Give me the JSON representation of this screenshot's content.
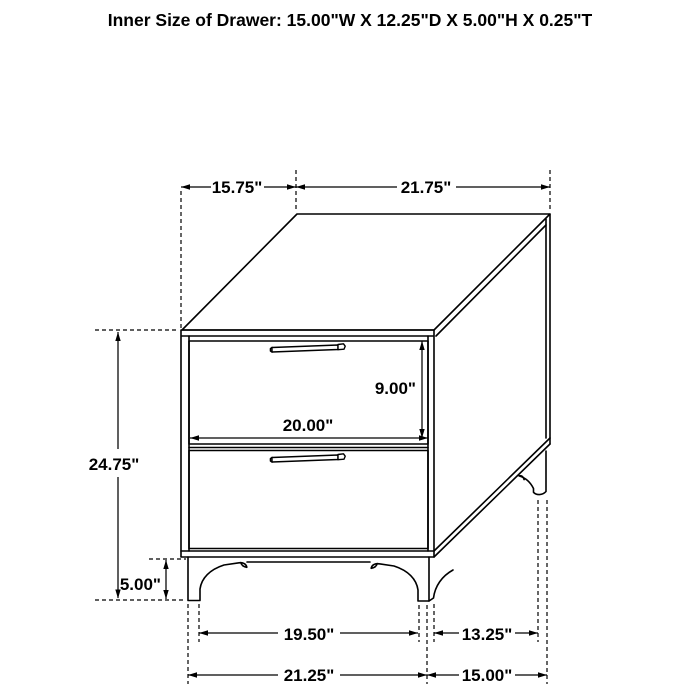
{
  "title": "Inner Size of Drawer: 15.00\"W X 12.25\"D X 5.00\"H X 0.25\"T",
  "colors": {
    "ink": "#000000",
    "background": "#ffffff"
  },
  "dimensions": {
    "top_depth": "15.75\"",
    "top_width": "21.75\"",
    "drawer_front_height": "9.00\"",
    "drawer_front_width": "20.00\"",
    "overall_height": "24.75\"",
    "leg_height": "5.00\"",
    "front_feet_inner_span": "19.50\"",
    "side_feet_inner_span": "13.25\"",
    "front_feet_outer_span": "21.25\"",
    "side_feet_outer_span": "15.00\""
  }
}
